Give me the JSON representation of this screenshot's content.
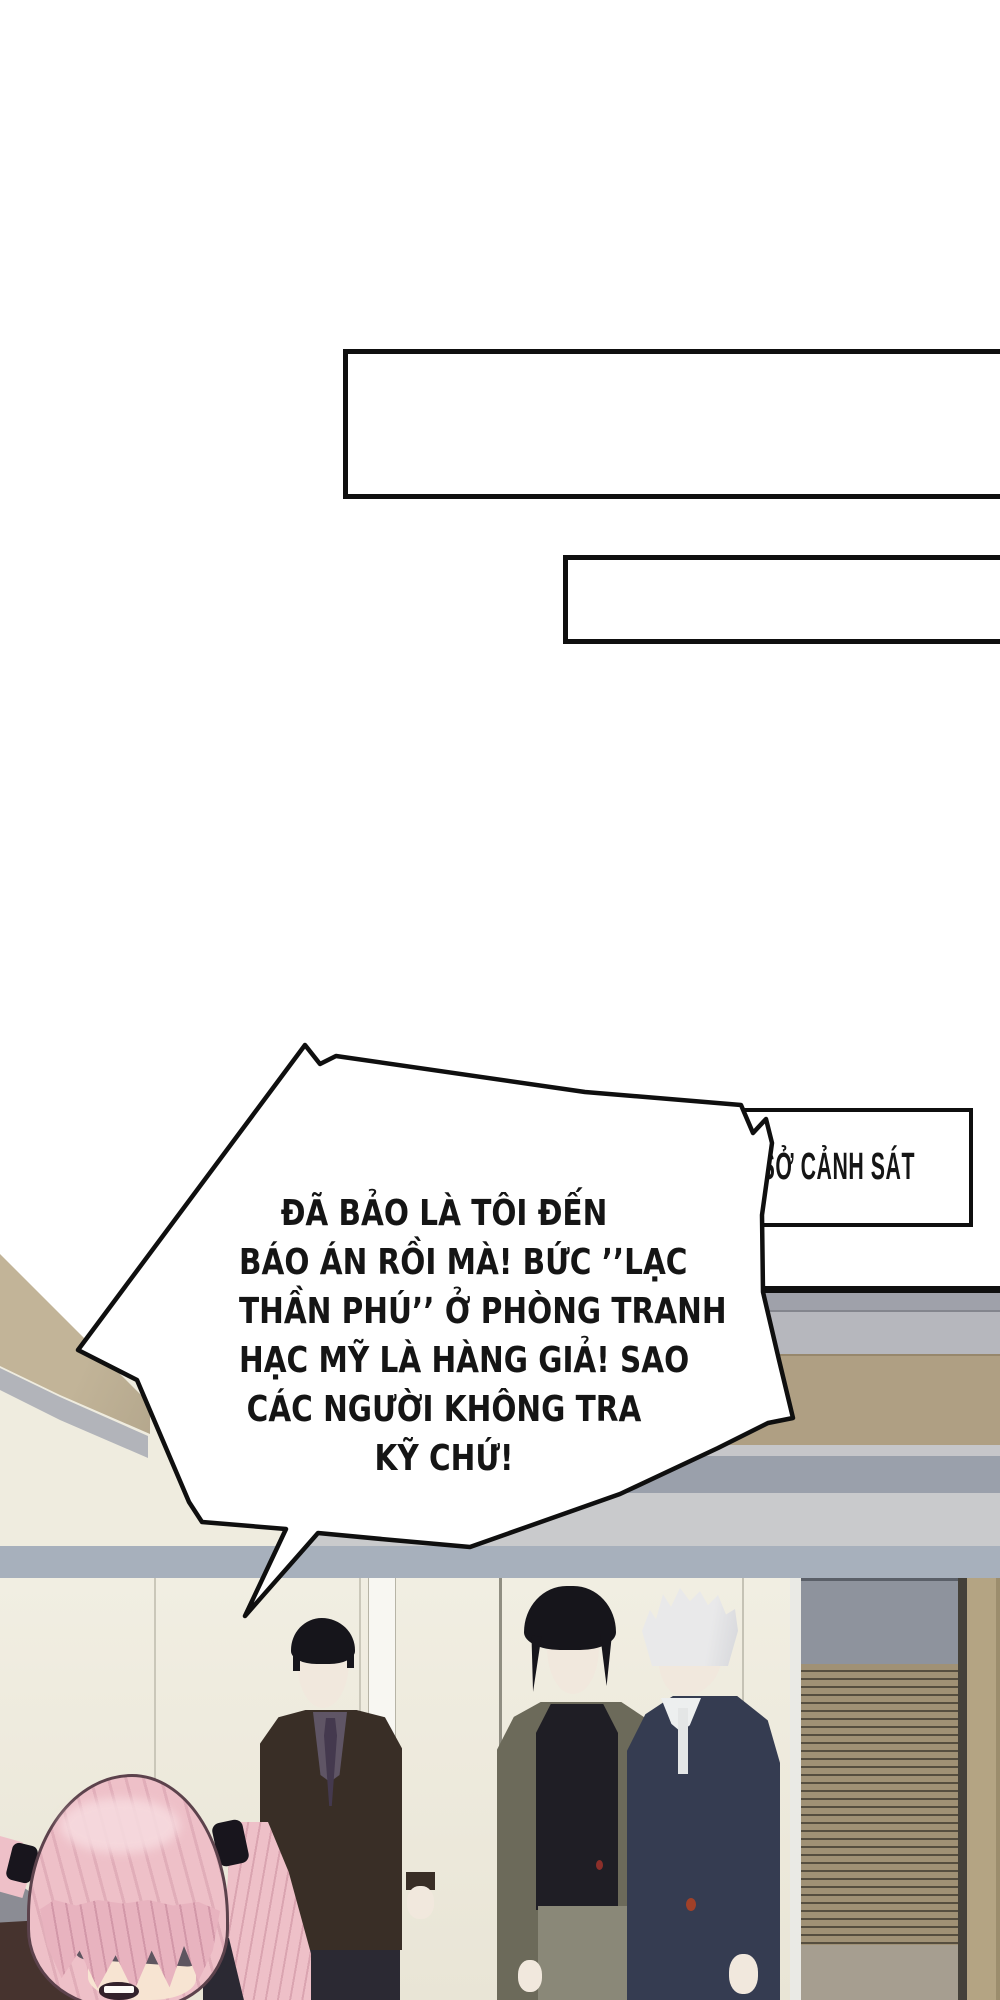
{
  "page": {
    "width": 1000,
    "height": 2000,
    "background": "#ffffff",
    "type": "comic-page"
  },
  "caption_boxes": [
    {
      "text": ""
    },
    {
      "text": ""
    }
  ],
  "sign": {
    "label": "SỞ CẢNH SÁT"
  },
  "speech_bubble": {
    "lines": [
      "ĐÃ BẢO LÀ TÔI ĐẾN",
      "BÁO ÁN RỒI MÀ! BỨC ’’LẠC",
      "THẦN PHÚ’’ Ở PHÒNG TRANH",
      "HẠC MỸ LÀ HÀNG GIẢ! SAO",
      "CÁC NGƯỜI KHÔNG TRA",
      "KỸ CHỨ!"
    ]
  },
  "colors": {
    "paper": "#ffffff",
    "ink": "#0f0f0f",
    "text": "#151515",
    "wall": "#f1eee2",
    "wall-deep": "#e9e5d6",
    "band-blue": "#a7b0bc",
    "band-blue-edge": "#8a919e",
    "gray-dark": "#9fa1aa",
    "gray-mid": "#b6b7bd",
    "gray-cool": "#9aa0ab",
    "pale-1": "#c6c6c9",
    "pale-2": "#c9cacc",
    "tan-band": "#af9f83",
    "tan-wedge": "#c2b498",
    "wedge-gray": "#b2b4ba",
    "cream": "#efecdf",
    "glass": "#8e939d",
    "frame-white": "#eaeae5",
    "door-white": "#f8f7f2",
    "blind-tan": "#a09175",
    "blind-dark": "#564e3f",
    "blind-base": "#a69e90",
    "divider": "#45413a",
    "wood": "#b4a483",
    "wood-edge": "#9c8d6d",
    "suit-brown": "#392e26",
    "shirt-purple": "#5f5565",
    "tie-purple": "#44394e",
    "suit-olive": "#6c6a5a",
    "shirt-black": "#1f1e25",
    "trouser-khaki": "#8a8878",
    "trouser-dark": "#2b2933",
    "suit-navy": "#353c51",
    "shirt-white": "#edefef",
    "hair-black": "#16151b",
    "hair-white": "#e9e9ea",
    "hair-shadow": "#a9aab2",
    "skin": "#f1e8dd",
    "skin-warm": "#f7e4d2",
    "hair-pink": "#eec0c8",
    "hair-pink-deep": "#e8b3bf",
    "hair-pink-line": "#5c424c",
    "hair-pink-hi": "#f7dce0",
    "hairband": "#18151d",
    "blindfold": "#5e5560",
    "chair-gray": "#8b8c94",
    "corner-dark": "#46332e",
    "red-spot": "#8c2f2a",
    "red-spot-2": "#a04028"
  }
}
